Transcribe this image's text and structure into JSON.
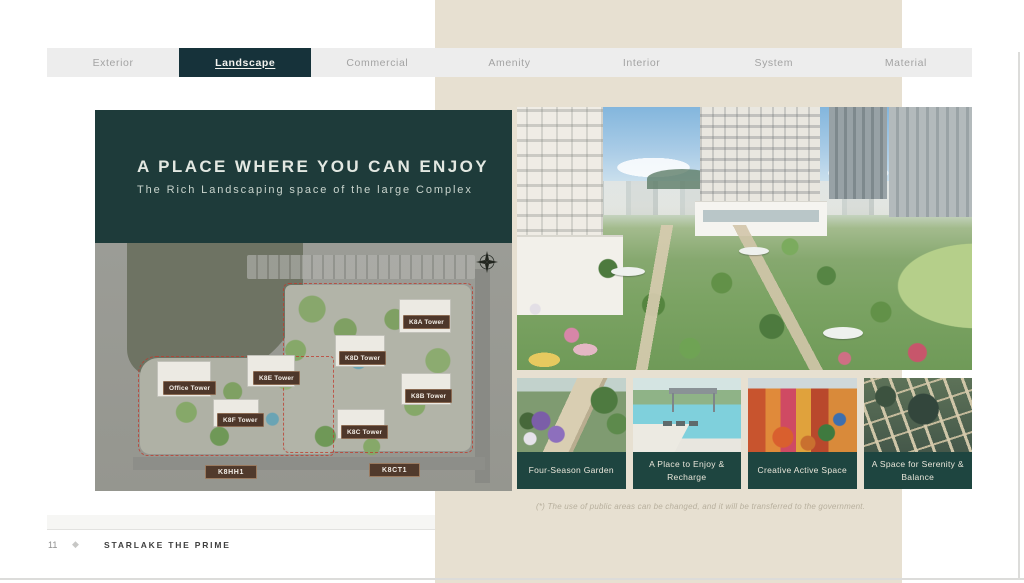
{
  "tabs": {
    "items": [
      {
        "label": "Exterior",
        "active": false
      },
      {
        "label": "Landscape",
        "active": true
      },
      {
        "label": "Commercial",
        "active": false
      },
      {
        "label": "Amenity",
        "active": false
      },
      {
        "label": "Interior",
        "active": false
      },
      {
        "label": "System",
        "active": false
      },
      {
        "label": "Material",
        "active": false
      }
    ]
  },
  "hero": {
    "title": "A PLACE WHERE YOU CAN ENJOY",
    "subtitle": "The Rich Landscaping space of the large Complex"
  },
  "site_map": {
    "towers": [
      "Office Tower",
      "K8E Tower",
      "K8F Tower",
      "K8A Tower",
      "K8D Tower",
      "K8B Tower",
      "K8C Tower"
    ],
    "zones": [
      "K8HH1",
      "K8CT1"
    ],
    "compass_icon": "compass-rose"
  },
  "thumbnails": [
    {
      "caption": "Four-Season Garden"
    },
    {
      "caption": "A Place to Enjoy & Recharge"
    },
    {
      "caption": "Creative Active Space"
    },
    {
      "caption": "A Space for Serenity & Balance"
    }
  ],
  "footnote": "(*) The use of public areas can be changed, and it will be transferred to the government.",
  "footer": {
    "page": "11",
    "brand": "STARLAKE THE PRIME"
  },
  "colors": {
    "panel_teal": "#1e3b3a",
    "tab_active_teal": "#16323a",
    "caption_teal": "#1e4540",
    "label_brown": "#4e372a",
    "beige_band": "#e7e0d1"
  }
}
